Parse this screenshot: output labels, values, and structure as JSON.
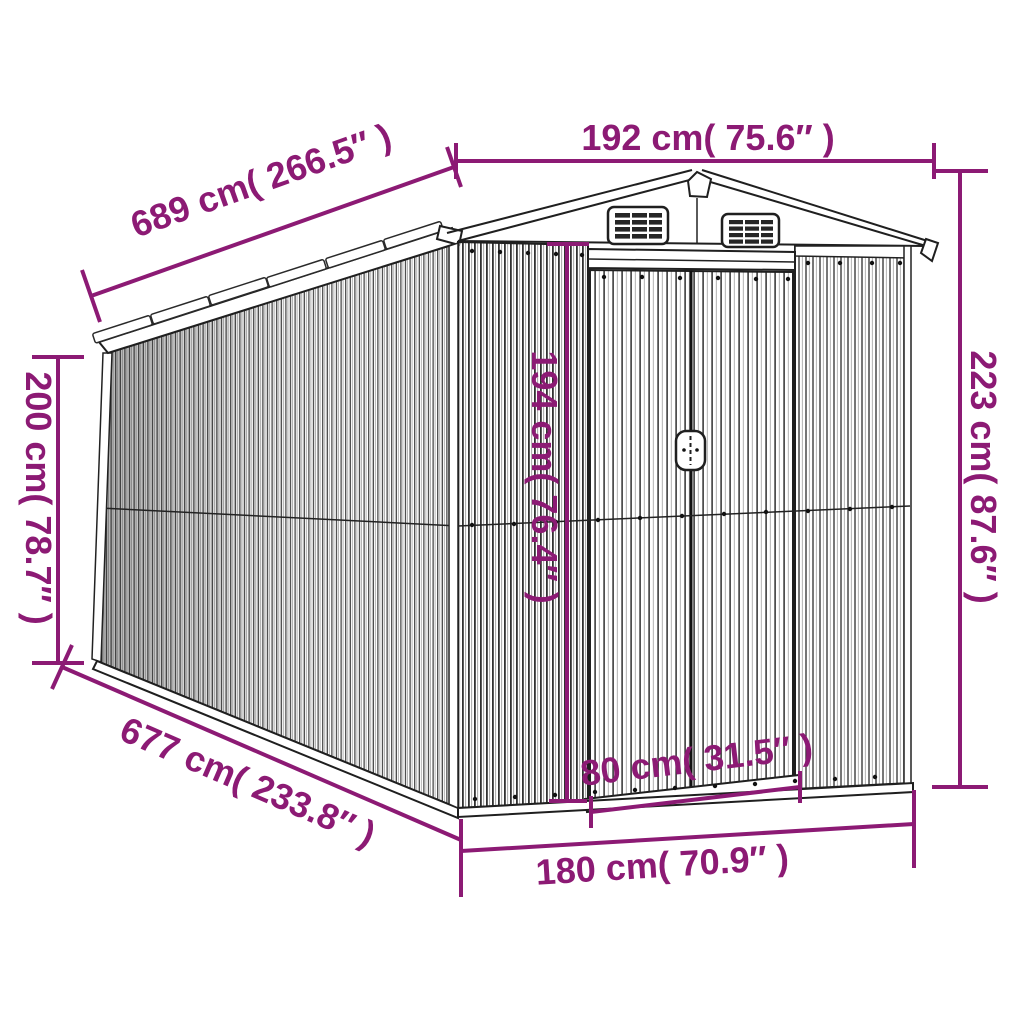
{
  "diagram": {
    "kind": "product-dimension-diagram",
    "subject": "metal garden shed with double sliding doors, gable roof and two gable vents",
    "accent_color": "#8c1a74",
    "line_color": "#1f1f1f"
  },
  "labels": {
    "front_width": "192 cm( 75.6″ )",
    "roof_length": "689 cm( 266.5″ )",
    "side_height": "200 cm( 78.7″ )",
    "total_height": "223 cm( 87.6″ )",
    "door_height": "194 cm( 76.4″ )",
    "door_width": "80 cm( 31.5″ )",
    "base_length": "677 cm( 233.8″ )",
    "base_front_width": "180 cm( 70.9″ )"
  }
}
